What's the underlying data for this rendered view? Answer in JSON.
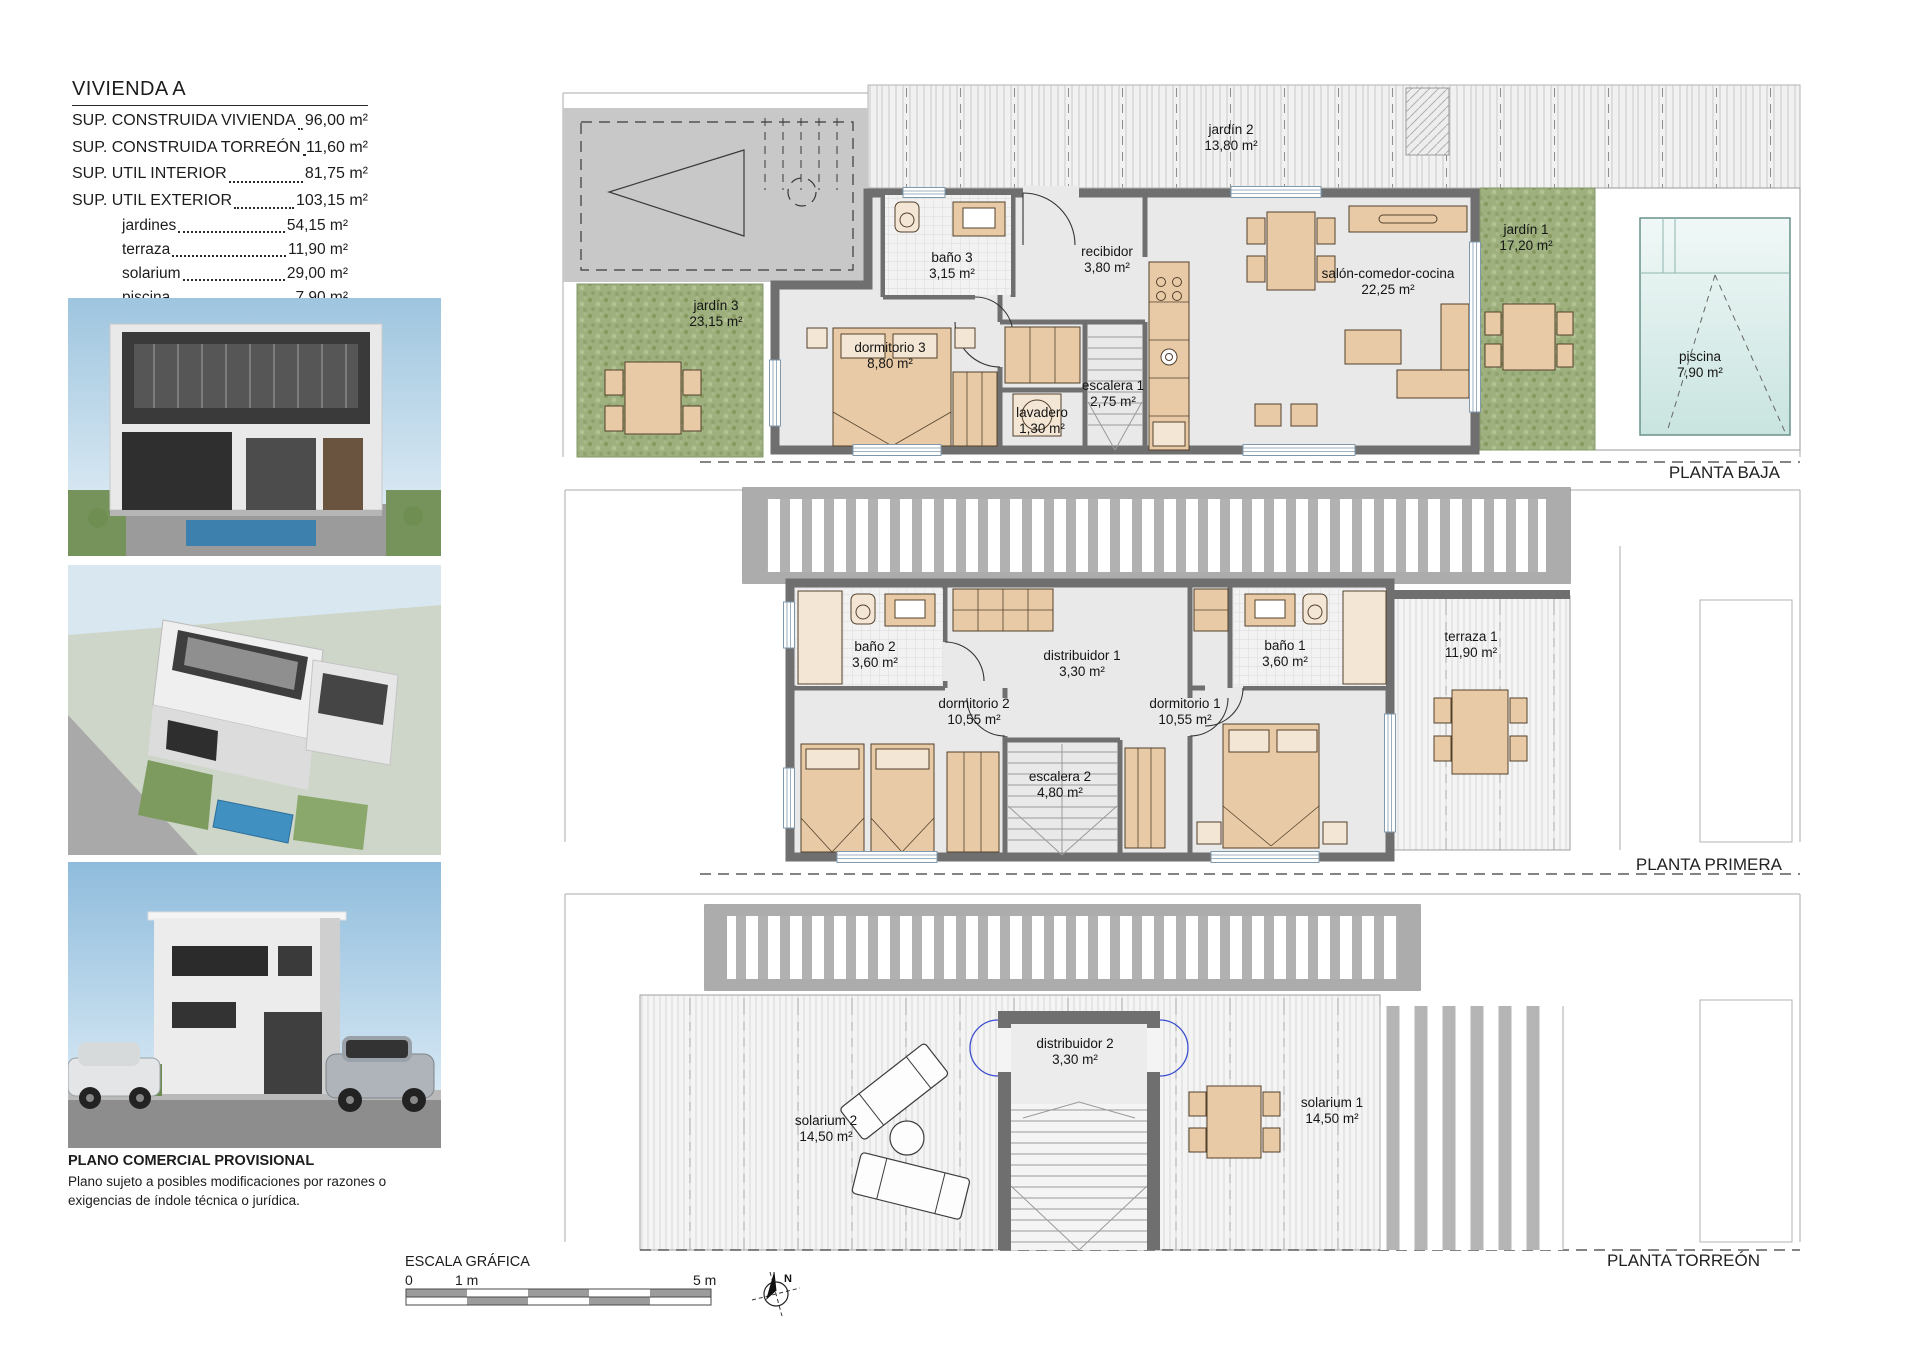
{
  "title_block": {
    "title": "VIVIENDA A",
    "specs": [
      {
        "label": "SUP. CONSTRUIDA VIVIENDA",
        "value": "96,00 m²"
      },
      {
        "label": "SUP. CONSTRUIDA TORREÓN",
        "value": "11,60 m²"
      },
      {
        "label": "SUP. UTIL INTERIOR",
        "value": "81,75 m²"
      },
      {
        "label": "SUP. UTIL EXTERIOR",
        "value": "103,15 m²"
      }
    ],
    "sub_specs": [
      {
        "label": "jardines",
        "value": "54,15 m²"
      },
      {
        "label": "terraza",
        "value": "11,90 m²"
      },
      {
        "label": "solarium",
        "value": "29,00 m²"
      },
      {
        "label": "piscina",
        "value": "7,90 m²"
      }
    ]
  },
  "plans": [
    {
      "name": "PLANTA BAJA",
      "rooms": [
        {
          "name": "jardín 2",
          "area": "13,80 m²"
        },
        {
          "name": "jardín 3",
          "area": "23,15 m²"
        },
        {
          "name": "baño 3",
          "area": "3,15 m²"
        },
        {
          "name": "recibidor",
          "area": "3,80 m²"
        },
        {
          "name": "dormitorio 3",
          "area": "8,80 m²"
        },
        {
          "name": "escalera 1",
          "area": "2,75 m²"
        },
        {
          "name": "lavadero",
          "area": "1,30 m²"
        },
        {
          "name": "salón-comedor-cocina",
          "area": "22,25 m²"
        },
        {
          "name": "jardín 1",
          "area": "17,20 m²"
        },
        {
          "name": "piscina",
          "area": "7,90 m²"
        }
      ]
    },
    {
      "name": "PLANTA PRIMERA",
      "rooms": [
        {
          "name": "baño 2",
          "area": "3,60 m²"
        },
        {
          "name": "distribuidor 1",
          "area": "3,30 m²"
        },
        {
          "name": "baño 1",
          "area": "3,60 m²"
        },
        {
          "name": "dormitorio 2",
          "area": "10,55 m²"
        },
        {
          "name": "dormitorio 1",
          "area": "10,55 m²"
        },
        {
          "name": "escalera 2",
          "area": "4,80 m²"
        },
        {
          "name": "terraza 1",
          "area": "11,90 m²"
        }
      ]
    },
    {
      "name": "PLANTA TORREÓN",
      "rooms": [
        {
          "name": "solarium 2",
          "area": "14,50 m²"
        },
        {
          "name": "distribuidor 2",
          "area": "3,30 m²"
        },
        {
          "name": "solarium 1",
          "area": "14,50 m²"
        }
      ]
    }
  ],
  "footer": {
    "disclaimer_title": "PLANO COMERCIAL PROVISIONAL",
    "disclaimer_body": "Plano sujeto a posibles modificaciones por razones o exigencias de índole técnica o jurídica.",
    "scale_label": "ESCALA GRÁFICA",
    "scale_ticks": [
      "0",
      "1 m",
      "5 m"
    ],
    "north_label": "N"
  }
}
